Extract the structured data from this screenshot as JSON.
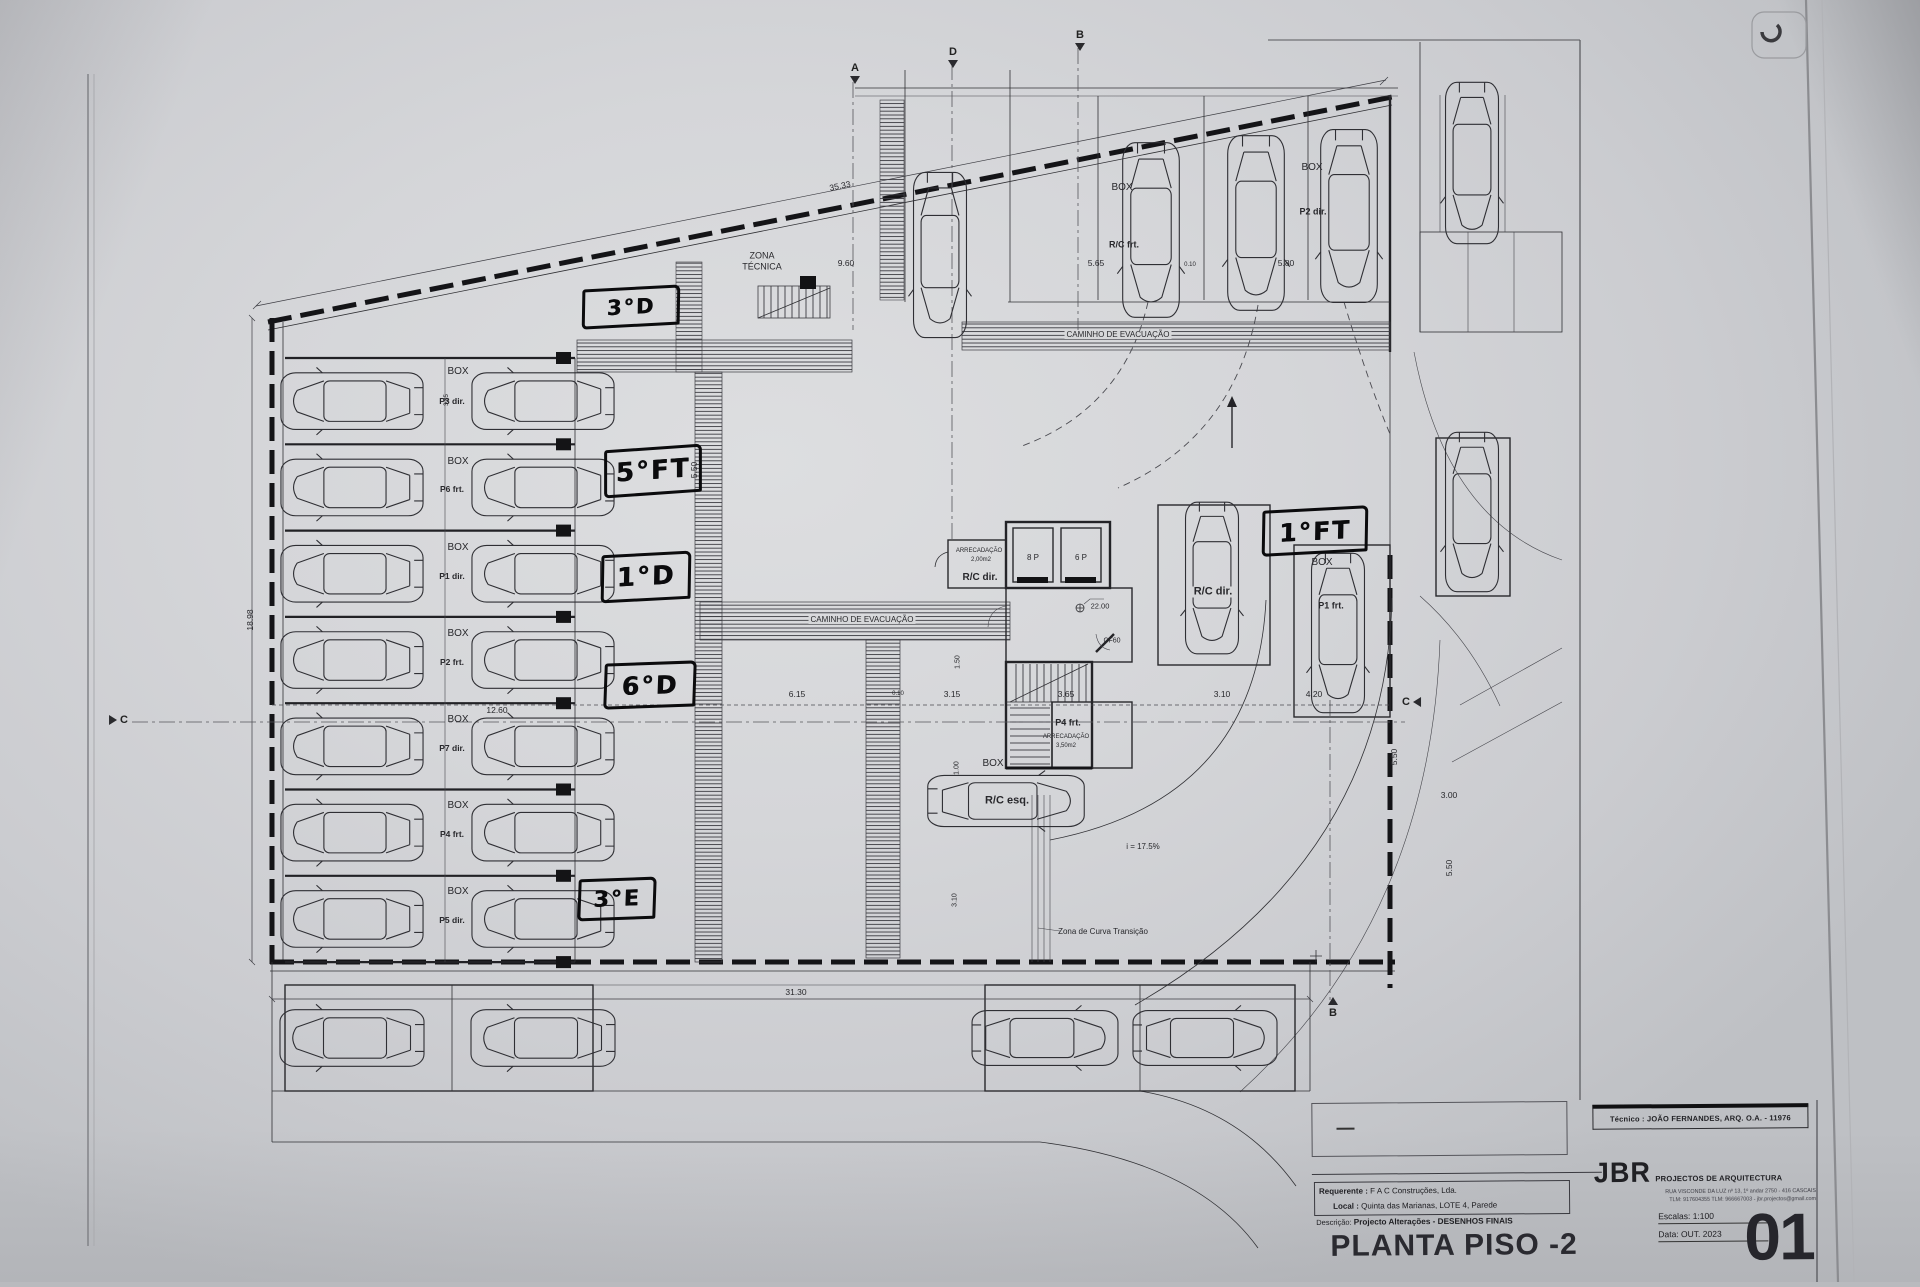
{
  "title_block": {
    "tecnico": "Técnico : JOÃO FERNANDES, ARQ.   O.A. - 11976",
    "firm_initials": "JBR",
    "firm_name": "PROJECTOS DE ARQUITECTURA",
    "firm_address": "RUA VISCONDE DA LUZ nº 13, 1º andar  2750 - 416  CASCAIS",
    "firm_contacts": "TLM: 917604355  TLM: 966667003 - jbr.projectos@gmail.com",
    "requerente_label": "Requerente :",
    "requerente": "F A C  Construções, Lda.",
    "local_label": "Local :",
    "local": "Quinta das Marianas, LOTE 4, Parede",
    "descricao_label": "Descrição:",
    "descricao": "Projecto Alterações - DESENHOS FINAIS",
    "drawing_title": "PLANTA PISO -2",
    "escalas": "Escalas:  1:100",
    "data": "Data: OUT.  2023",
    "sheet_number": "01"
  },
  "annotations": [
    {
      "text": "3°D",
      "x": 628,
      "y": 304,
      "w": 92,
      "h": 34,
      "rot": -3
    },
    {
      "text": "5°FT",
      "x": 650,
      "y": 468,
      "w": 92,
      "h": 42,
      "rot": -4
    },
    {
      "text": "1°D",
      "x": 643,
      "y": 574,
      "w": 84,
      "h": 42,
      "rot": -3
    },
    {
      "text": "6°D",
      "x": 647,
      "y": 682,
      "w": 86,
      "h": 40,
      "rot": -2
    },
    {
      "text": "3°E",
      "x": 614,
      "y": 896,
      "w": 72,
      "h": 36,
      "rot": -2
    },
    {
      "text": "1°FT",
      "x": 1312,
      "y": 528,
      "w": 100,
      "h": 40,
      "rot": -3
    }
  ],
  "section_markers": [
    {
      "letter": "A",
      "x": 855,
      "y": 73,
      "dir": "down"
    },
    {
      "letter": "D",
      "x": 953,
      "y": 57,
      "dir": "down"
    },
    {
      "letter": "B",
      "x": 1080,
      "y": 40,
      "dir": "down"
    },
    {
      "letter": "C",
      "x": 118,
      "y": 720,
      "dir": "right"
    },
    {
      "letter": "C",
      "x": 1412,
      "y": 702,
      "dir": "left"
    },
    {
      "letter": "B",
      "x": 1333,
      "y": 1008,
      "dir": "up"
    }
  ],
  "plan_labels": [
    {
      "name": "zona-tecnica-line1",
      "text": "ZONA",
      "x": 762,
      "y": 256,
      "fs": 9
    },
    {
      "name": "zona-tecnica-line2",
      "text": "TÉCNICA",
      "x": 762,
      "y": 267,
      "fs": 9
    },
    {
      "name": "caminho-evacuacao-top",
      "text": "CAMINHO  DE  EVACUAÇÃO",
      "x": 1118,
      "y": 335,
      "fs": 8,
      "bg": 1
    },
    {
      "name": "caminho-evacuacao-mid",
      "text": "CAMINHO  DE  EVACUAÇÃO",
      "x": 862,
      "y": 620,
      "fs": 8,
      "bg": 1
    },
    {
      "name": "box-row-1",
      "text": "BOX",
      "x": 458,
      "y": 372,
      "fs": 10
    },
    {
      "name": "box-row-2",
      "text": "BOX",
      "x": 458,
      "y": 462,
      "fs": 10
    },
    {
      "name": "box-row-3",
      "text": "BOX",
      "x": 458,
      "y": 548,
      "fs": 10
    },
    {
      "name": "box-row-4",
      "text": "BOX",
      "x": 458,
      "y": 634,
      "fs": 10
    },
    {
      "name": "box-row-5",
      "text": "BOX",
      "x": 458,
      "y": 720,
      "fs": 10
    },
    {
      "name": "box-row-6",
      "text": "BOX",
      "x": 458,
      "y": 806,
      "fs": 10
    },
    {
      "name": "box-row-7",
      "text": "BOX",
      "x": 458,
      "y": 892,
      "fs": 10
    },
    {
      "name": "stall-row-1",
      "text": "P3 dir.",
      "x": 452,
      "y": 401,
      "fs": 8.5,
      "b": 1
    },
    {
      "name": "stall-row-2",
      "text": "P6 frt.",
      "x": 452,
      "y": 489,
      "fs": 8.5,
      "b": 1
    },
    {
      "name": "stall-row-3",
      "text": "P1 dir.",
      "x": 452,
      "y": 576,
      "fs": 8.5,
      "b": 1
    },
    {
      "name": "stall-row-4",
      "text": "P2 frt.",
      "x": 452,
      "y": 662,
      "fs": 8.5,
      "b": 1
    },
    {
      "name": "stall-row-5",
      "text": "P7 dir.",
      "x": 452,
      "y": 748,
      "fs": 8.5,
      "b": 1
    },
    {
      "name": "stall-row-6",
      "text": "P4 frt.",
      "x": 452,
      "y": 834,
      "fs": 8.5,
      "b": 1
    },
    {
      "name": "stall-row-7",
      "text": "P5 dir.",
      "x": 452,
      "y": 920,
      "fs": 8.5,
      "b": 1
    },
    {
      "name": "box-top-1",
      "text": "BOX",
      "x": 1122,
      "y": 188,
      "fs": 10
    },
    {
      "name": "rc-frt",
      "text": "R/C frt.",
      "x": 1124,
      "y": 245,
      "fs": 9,
      "b": 1
    },
    {
      "name": "box-top-2",
      "text": "BOX",
      "x": 1312,
      "y": 168,
      "fs": 10
    },
    {
      "name": "p2-dir",
      "text": "P2 dir.",
      "x": 1313,
      "y": 212,
      "fs": 9,
      "b": 1
    },
    {
      "name": "box-right",
      "text": "BOX",
      "x": 1322,
      "y": 563,
      "fs": 10
    },
    {
      "name": "p1-frt",
      "text": "P1 frt.",
      "x": 1331,
      "y": 606,
      "fs": 9,
      "b": 1
    },
    {
      "name": "rc-dir-right",
      "text": "R/C dir.",
      "x": 1213,
      "y": 592,
      "fs": 11,
      "b": 1,
      "bg": 1
    },
    {
      "name": "rc-dir-core",
      "text": "R/C dir.",
      "x": 980,
      "y": 578,
      "fs": 10,
      "b": 1
    },
    {
      "name": "arrecadacao1-line1",
      "text": "ARRECADAÇÃO",
      "x": 979,
      "y": 551,
      "fs": 6
    },
    {
      "name": "arrecadacao1-line2",
      "text": "2,00m2",
      "x": 981,
      "y": 560,
      "fs": 6
    },
    {
      "name": "lift-8p",
      "text": "8 P",
      "x": 1033,
      "y": 558,
      "fs": 8
    },
    {
      "name": "lift-6p",
      "text": "6 P",
      "x": 1081,
      "y": 558,
      "fs": 8
    },
    {
      "name": "level-22",
      "text": "22.00",
      "x": 1100,
      "y": 606,
      "fs": 7.5
    },
    {
      "name": "cf60",
      "text": "CF60",
      "x": 1112,
      "y": 641,
      "fs": 7
    },
    {
      "name": "p4-frt-core",
      "text": "P4 frt.",
      "x": 1068,
      "y": 723,
      "fs": 9,
      "b": 1
    },
    {
      "name": "arrecadacao2-line1",
      "text": "ARRECADAÇÃO",
      "x": 1066,
      "y": 737,
      "fs": 6
    },
    {
      "name": "arrecadacao2-line2",
      "text": "3,50m2",
      "x": 1066,
      "y": 746,
      "fs": 6
    },
    {
      "name": "box-rc-esq",
      "text": "BOX",
      "x": 993,
      "y": 764,
      "fs": 10
    },
    {
      "name": "rc-esq",
      "text": "R/C esq.",
      "x": 1007,
      "y": 801,
      "fs": 11,
      "b": 1
    },
    {
      "name": "ramp-slope",
      "text": "i = 17.5%",
      "x": 1143,
      "y": 847,
      "fs": 8
    },
    {
      "name": "zona-curva",
      "text": "Zona de Curva Transição",
      "x": 1103,
      "y": 932,
      "fs": 8
    },
    {
      "name": "dim-35-33",
      "text": "35.33",
      "x": 840,
      "y": 186,
      "fs": 8.5,
      "rot": -11.5
    },
    {
      "name": "dim-9-60",
      "text": "9.60",
      "x": 846,
      "y": 263,
      "fs": 8.5
    },
    {
      "name": "dim-5-65",
      "text": "5.65",
      "x": 1096,
      "y": 263,
      "fs": 8.5
    },
    {
      "name": "dim-0-10-top",
      "text": "0.10",
      "x": 1190,
      "y": 265,
      "fs": 6
    },
    {
      "name": "dim-5-80",
      "text": "5.80",
      "x": 1286,
      "y": 263,
      "fs": 8.5
    },
    {
      "name": "dim-31-30",
      "text": "31.30",
      "x": 796,
      "y": 992,
      "fs": 8.5
    },
    {
      "name": "dim-6-15",
      "text": "6.15",
      "x": 797,
      "y": 694,
      "fs": 8.5
    },
    {
      "name": "dim-0-10-mid",
      "text": "0.10",
      "x": 898,
      "y": 694,
      "fs": 6
    },
    {
      "name": "dim-3-15",
      "text": "3.15",
      "x": 952,
      "y": 694,
      "fs": 8.5
    },
    {
      "name": "dim-3-65",
      "text": "3.65",
      "x": 1066,
      "y": 694,
      "fs": 8.5
    },
    {
      "name": "dim-3-10",
      "text": "3.10",
      "x": 1222,
      "y": 694,
      "fs": 8.5
    },
    {
      "name": "dim-4-20",
      "text": "4.20",
      "x": 1314,
      "y": 694,
      "fs": 8.5
    },
    {
      "name": "dim-3-00",
      "text": "3.00",
      "x": 1449,
      "y": 795,
      "fs": 8.5
    },
    {
      "name": "dim-12-60",
      "text": "12.60",
      "x": 497,
      "y": 710,
      "fs": 8.5
    },
    {
      "name": "dim-18-98",
      "text": "18.98",
      "x": 250,
      "y": 620,
      "fs": 8.5,
      "rot": -90
    },
    {
      "name": "dim-5-50-aisle",
      "text": "5.50",
      "x": 694,
      "y": 470,
      "fs": 8.5,
      "rot": -90
    },
    {
      "name": "dim-1-50",
      "text": "1.50",
      "x": 958,
      "y": 662,
      "fs": 7,
      "rot": -90
    },
    {
      "name": "dim-1-00",
      "text": "1.00",
      "x": 957,
      "y": 768,
      "fs": 7,
      "rot": -90
    },
    {
      "name": "dim-3-10-v",
      "text": "3.10",
      "x": 955,
      "y": 900,
      "fs": 7,
      "rot": -90
    },
    {
      "name": "dim-5-50-right",
      "text": "5.50",
      "x": 1394,
      "y": 757,
      "fs": 8.5,
      "rot": -90
    },
    {
      "name": "dim-5-50-street",
      "text": "5.50",
      "x": 1449,
      "y": 868,
      "fs": 8.5,
      "rot": -90
    },
    {
      "name": "dim-3-85",
      "text": "3.85",
      "x": 447,
      "y": 400,
      "fs": 6,
      "rot": -90
    }
  ]
}
